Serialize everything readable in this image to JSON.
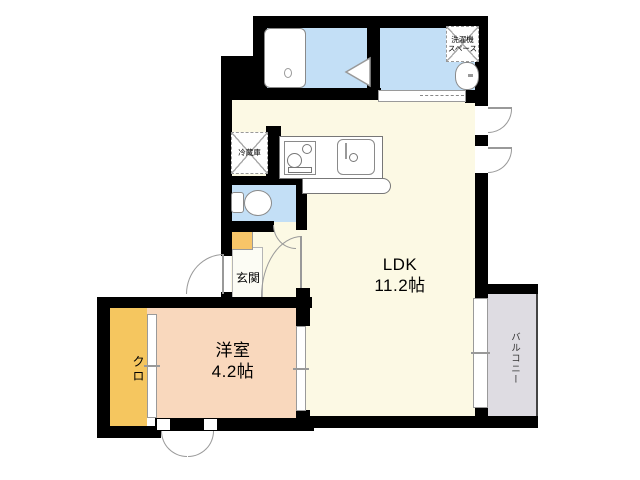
{
  "floorplan": {
    "rooms": {
      "ldk_name": "LDK",
      "ldk_size": "11.2帖",
      "bedroom_name": "洋室",
      "bedroom_size": "4.2帖",
      "entrance_label": "玄関",
      "closet_label": "クロ",
      "balcony_label": "バルコニー",
      "refrigerator_label": "冷蔵庫",
      "washer_label_line1": "洗濯機",
      "washer_label_line2": "スペース"
    },
    "colors": {
      "wall": "#000000",
      "ldk_floor": "#FCF9E4",
      "bedroom_floor": "#F9D8BD",
      "closet_fill": "#F5C65F",
      "shoe_cabinet_fill": "#F7C568",
      "wet_area_floor": "#C3DFF6",
      "balcony_floor": "#DEDCE2",
      "entrance_floor": "#FCFCF4"
    }
  }
}
